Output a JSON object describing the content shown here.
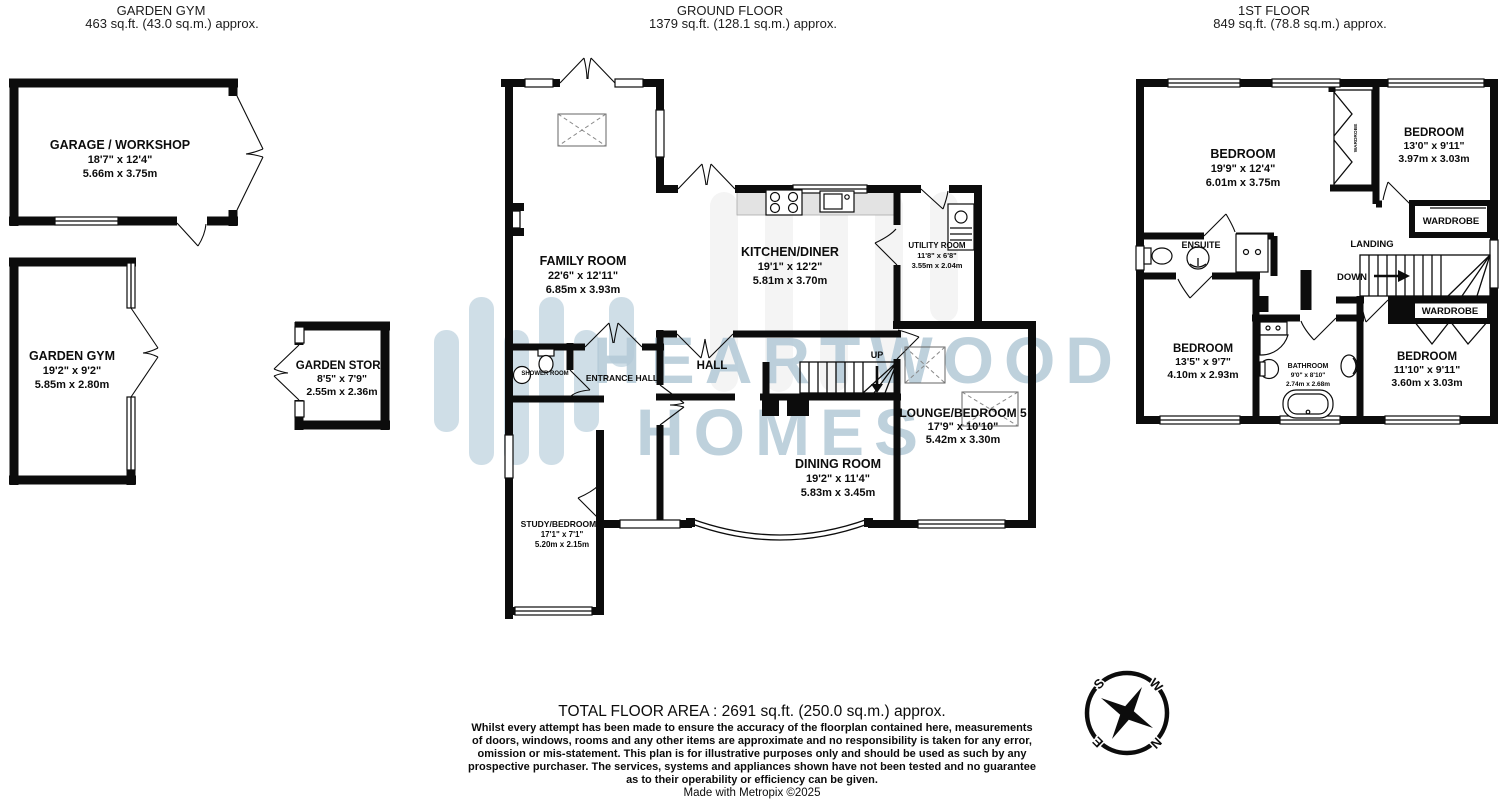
{
  "sections": {
    "garden_gym": {
      "title": "GARDEN GYM",
      "area": "463 sq.ft. (43.0 sq.m.) approx."
    },
    "ground_floor": {
      "title": "GROUND FLOOR",
      "area": "1379 sq.ft. (128.1 sq.m.) approx."
    },
    "first_floor": {
      "title": "1ST FLOOR",
      "area": "849 sq.ft. (78.8 sq.m.) approx."
    }
  },
  "rooms": {
    "garage": {
      "name": "GARAGE / WORKSHOP",
      "imperial": "18'7\"  x 12'4\"",
      "metric": "5.66m  x 3.75m"
    },
    "garden_gym": {
      "name": "GARDEN GYM",
      "imperial": "19'2\"  x 9'2\"",
      "metric": "5.85m  x 2.80m"
    },
    "garden_store": {
      "name": "GARDEN STORE",
      "imperial": "8'5\"  x 7'9\"",
      "metric": "2.55m  x 2.36m"
    },
    "family": {
      "name": "FAMILY ROOM",
      "imperial": "22'6\"  x 12'11\"",
      "metric": "6.85m  x 3.93m"
    },
    "kitchen": {
      "name": "KITCHEN/DINER",
      "imperial": "19'1\"  x 12'2\"",
      "metric": "5.81m  x 3.70m"
    },
    "utility": {
      "name": "UTILITY ROOM",
      "imperial": "11'8\"  x 6'8\"",
      "metric": "3.55m  x 2.04m"
    },
    "dining": {
      "name": "DINING ROOM",
      "imperial": "19'2\"  x 11'4\"",
      "metric": "5.83m  x 3.45m"
    },
    "lounge": {
      "name": "LOUNGE/BEDROOM 5",
      "imperial": "17'9\"  x 10'10\"",
      "metric": "5.42m  x 3.30m"
    },
    "study": {
      "name": "STUDY/BEDROOM 6",
      "imperial": "17'1\"  x 7'1\"",
      "metric": "5.20m  x 2.15m"
    },
    "bedroom1": {
      "name": "BEDROOM",
      "imperial": "19'9\"  x 12'4\"",
      "metric": "6.01m  x 3.75m"
    },
    "bedroom2": {
      "name": "BEDROOM",
      "imperial": "13'0\"  x 9'11\"",
      "metric": "3.97m  x 3.03m"
    },
    "bedroom3": {
      "name": "BEDROOM",
      "imperial": "13'5\"  x 9'7\"",
      "metric": "4.10m  x 2.93m"
    },
    "bedroom4": {
      "name": "BEDROOM",
      "imperial": "11'10\"  x 9'11\"",
      "metric": "3.60m  x 3.03m"
    },
    "bathroom": {
      "name": "BATHROOM",
      "imperial": "9'0\"  x 8'10\"",
      "metric": "2.74m  x 2.68m"
    }
  },
  "labels": {
    "hall": "HALL",
    "entrance_hall": "ENTRANCE HALL",
    "shower_room": "SHOWER ROOM",
    "ensuite": "ENSUITE",
    "landing": "LANDING",
    "wardrobe": "WARDROBE",
    "up": "UP",
    "down": "DOWN"
  },
  "compass": {
    "n": "N",
    "s": "S",
    "e": "E",
    "w": "W"
  },
  "watermark": {
    "line1": "HEARTWOOD",
    "line2": "HOMES",
    "color": "#b3c9d7"
  },
  "footer": {
    "total_area": "TOTAL FLOOR AREA : 2691 sq.ft. (250.0 sq.m.) approx.",
    "disclaimer": [
      "Whilst every attempt has been made to ensure the accuracy of the floorplan contained here, measurements",
      "of doors, windows, rooms and any other items are approximate and no responsibility is taken for any error,",
      "omission or mis-statement. This plan is for illustrative purposes only and should be used as such by any",
      "prospective purchaser. The services, systems and appliances shown have not been tested and no guarantee",
      "as to their operability or efficiency can be given."
    ],
    "credit": "Made with Metropix ©2025"
  }
}
